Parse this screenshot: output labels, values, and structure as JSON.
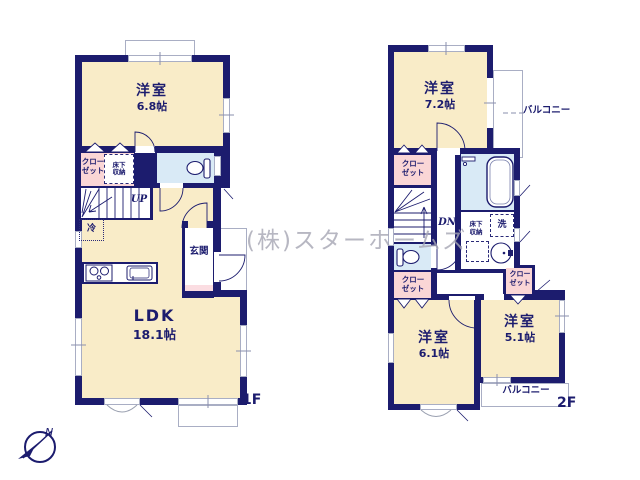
{
  "company_watermark": "(株)スターホームズ",
  "compass": {
    "north": "N"
  },
  "colors": {
    "wall": "#1c1c6e",
    "room": "#f9ecc8",
    "closet": "#fad6d6",
    "wet_area": "#d9eaf6",
    "watermark": "#a6a6b4"
  },
  "floor1": {
    "label": "1F",
    "bedroom": {
      "name": "洋室",
      "size": "6.8帖"
    },
    "ldk": {
      "name": "LDK",
      "size": "18.1帖"
    },
    "entrance": "玄関",
    "closet": [
      "クロー",
      "ゼット"
    ],
    "underfloor_storage": [
      "床下",
      "収納"
    ],
    "stairs": "UP",
    "refrigerator": "冷"
  },
  "floor2": {
    "label": "2F",
    "bedroom_1": {
      "name": "洋室",
      "size": "7.2帖"
    },
    "bedroom_2": {
      "name": "洋室",
      "size": "6.1帖"
    },
    "bedroom_3": {
      "name": "洋室",
      "size": "5.1帖"
    },
    "balcony_right": "バルコニー",
    "balcony_bottom": "バルコニー",
    "closet_top": [
      "クロー",
      "ゼット"
    ],
    "closet_left": [
      "クロー",
      "ゼット"
    ],
    "closet_right": [
      "クロー",
      "ゼット"
    ],
    "underfloor_storage": [
      "床下",
      "収納"
    ],
    "stairs": "DN",
    "laundry": "洗"
  }
}
